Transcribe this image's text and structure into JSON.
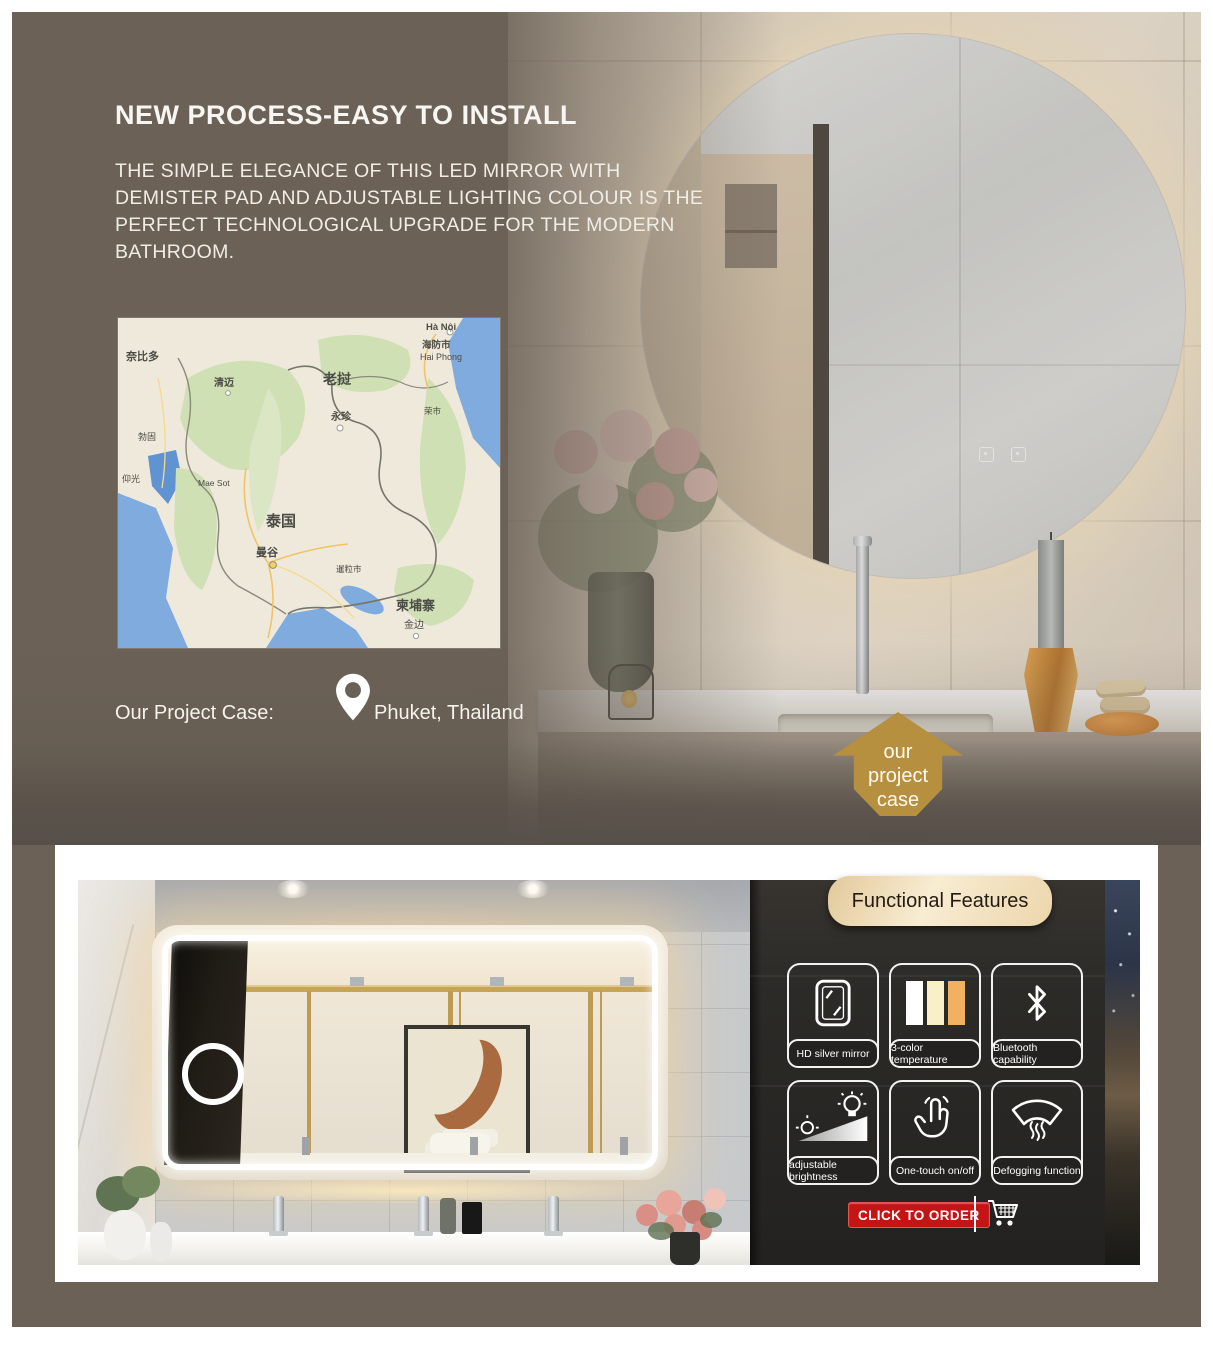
{
  "hero": {
    "title": "NEW PROCESS-EASY TO INSTALL",
    "description": "THE SIMPLE ELEGANCE OF THIS LED MIRROR WITH DEMISTER PAD AND ADJUSTABLE LIGHTING COLOUR IS THE PERFECT TECHNOLOGICAL UPGRADE FOR THE MODERN BATHROOM.",
    "project_case_label": "Our Project Case:",
    "project_case_location": "Phuket, Thailand"
  },
  "badge": {
    "lines": [
      "our",
      "project",
      "case"
    ]
  },
  "map": {
    "labels": [
      {
        "text": "奈比多"
      },
      {
        "text": "勃固"
      },
      {
        "text": "仰光"
      },
      {
        "text": "清迈"
      },
      {
        "text": "老挝"
      },
      {
        "text": "永珍"
      },
      {
        "text": "荣市"
      },
      {
        "text": "Hà Nội"
      },
      {
        "text": "海防市"
      },
      {
        "text": "Hai Phong"
      },
      {
        "text": "Mae Sot"
      },
      {
        "text": "泰国"
      },
      {
        "text": "曼谷"
      },
      {
        "text": "暹粒市"
      },
      {
        "text": "柬埔寨"
      },
      {
        "text": "金边"
      }
    ]
  },
  "features": {
    "header": "Functional Features",
    "items": [
      {
        "icon": "hd-mirror-icon",
        "label": "HD silver mirror"
      },
      {
        "icon": "color-temperature-icon",
        "label": "3-color temperature"
      },
      {
        "icon": "bluetooth-icon",
        "label": "Bluetooth capability"
      },
      {
        "icon": "adjustable-brightness-icon",
        "label": "adjustable brightness"
      },
      {
        "icon": "one-touch-icon",
        "label": "One-touch on/off"
      },
      {
        "icon": "defogging-icon",
        "label": "Defogging function"
      }
    ]
  },
  "order": {
    "button_label": "CLICK TO ORDER"
  },
  "colors": {
    "hero_background": "#6b6156",
    "badge_gold": "#b6903f",
    "arrow_dark": "#57504a",
    "feature_panel": "#272624",
    "pill_cream": "#f3e5c8",
    "order_red": "#c41414",
    "led_white": "#ffffff",
    "swatch_white": "#ffffff",
    "swatch_warm": "#faf0c8",
    "swatch_orange": "#f2b061",
    "map_water": "#7fabdf",
    "map_land": "#efe9dc",
    "map_forest": "#cfe0b4"
  }
}
